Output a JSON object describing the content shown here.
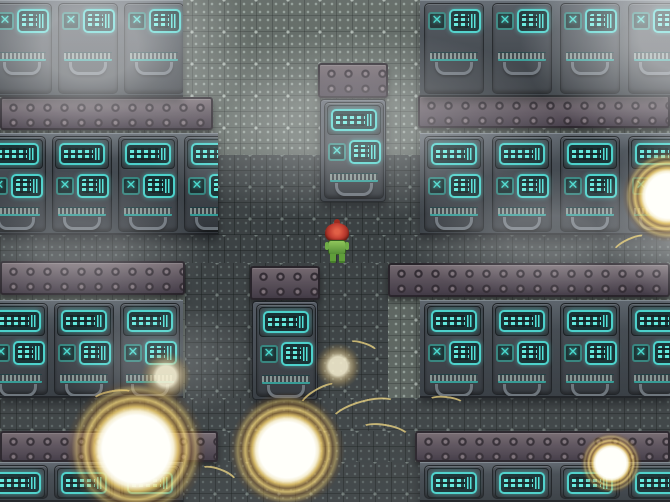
{
  "scene": {
    "width": 670,
    "height": 502,
    "type": "top-down-rpg",
    "setting": "sci-fi machine facility corridor"
  },
  "palette": {
    "wall": "#57605b",
    "wall_dot": "#c4d4cc",
    "floor": "#353b3d",
    "floor_dot": "#98aca6",
    "machine_light": "#565e66",
    "machine_dark": "#2e343a",
    "machine_edge": "#14181c",
    "screen_border": "#43cfc8",
    "screen_bg": "#0e282b",
    "screen_segment": "#60f0e4",
    "x_icon": "#3fd9cd",
    "beam": "#554c56",
    "beam_rivet": "#2b242c",
    "beam_edge": "#201b22",
    "explosion_core": "#fffdf4",
    "explosion_ring": "#f0c45e",
    "explosion_outer": "#a8762a",
    "player_hair": "#c23a2c",
    "player_body": "#7ab648",
    "fog": "#ffffff"
  },
  "icons": {
    "x_tile": "✕",
    "screen_bars": "equalizer-bars-icon",
    "rivet": "dot-rivet-icon",
    "vent": "slatted-vent-icon",
    "handle": "u-handle-icon"
  },
  "player": {
    "x": 325,
    "y": 219,
    "w": 24,
    "h": 45,
    "facing": "up"
  },
  "beams": [
    {
      "x": 0,
      "y": 97,
      "w": 213,
      "h": 33
    },
    {
      "x": 418,
      "y": 95,
      "w": 252,
      "h": 33
    },
    {
      "x": 0,
      "y": 261,
      "w": 185,
      "h": 34
    },
    {
      "x": 388,
      "y": 263,
      "w": 282,
      "h": 34
    },
    {
      "x": 0,
      "y": 431,
      "w": 218,
      "h": 31
    },
    {
      "x": 415,
      "y": 431,
      "w": 255,
      "h": 31
    }
  ],
  "floors": [
    {
      "x": 218,
      "y": 155,
      "w": 202,
      "h": 80
    },
    {
      "x": 0,
      "y": 235,
      "w": 670,
      "h": 28
    },
    {
      "x": 185,
      "y": 263,
      "w": 203,
      "h": 135
    },
    {
      "x": 0,
      "y": 398,
      "w": 670,
      "h": 33
    },
    {
      "x": 165,
      "y": 431,
      "w": 250,
      "h": 31
    },
    {
      "x": 183,
      "y": 462,
      "w": 237,
      "h": 40
    }
  ],
  "banks": [
    {
      "name": "top-left",
      "x": 0,
      "y": 0,
      "w": 183,
      "h": 97,
      "variant": "top",
      "units": [
        -8,
        58,
        124
      ]
    },
    {
      "name": "top-right",
      "x": 420,
      "y": 0,
      "w": 250,
      "h": 97,
      "variant": "top",
      "units": [
        4,
        72,
        140,
        208
      ]
    },
    {
      "name": "mid-left",
      "x": 0,
      "y": 133,
      "w": 218,
      "h": 102,
      "variant": "full",
      "units": [
        -14,
        52,
        118,
        184
      ]
    },
    {
      "name": "mid-right",
      "x": 420,
      "y": 133,
      "w": 250,
      "h": 102,
      "variant": "full",
      "units": [
        4,
        72,
        140,
        208
      ]
    },
    {
      "name": "lower-left",
      "x": 0,
      "y": 300,
      "w": 183,
      "h": 98,
      "variant": "full",
      "units": [
        -12,
        54,
        120
      ]
    },
    {
      "name": "lower-right",
      "x": 420,
      "y": 300,
      "w": 250,
      "h": 98,
      "variant": "full",
      "units": [
        4,
        72,
        140,
        208
      ]
    },
    {
      "name": "bottom-left",
      "x": 0,
      "y": 462,
      "w": 183,
      "h": 40,
      "variant": "cut",
      "units": [
        -12,
        54,
        120
      ]
    },
    {
      "name": "bottom-right",
      "x": 420,
      "y": 462,
      "w": 250,
      "h": 40,
      "variant": "cut",
      "units": [
        4,
        72,
        140,
        208
      ]
    }
  ],
  "pillars": [
    {
      "name": "door-top",
      "x": 318,
      "y": 63,
      "w": 70,
      "h": 139,
      "cap": 35
    },
    {
      "name": "door-bottom",
      "x": 250,
      "y": 266,
      "w": 70,
      "h": 134,
      "cap": 34
    }
  ],
  "explosions": [
    {
      "x": 136,
      "y": 449,
      "r": 70,
      "kind": "bright"
    },
    {
      "x": 287,
      "y": 450,
      "r": 58,
      "kind": "bright"
    },
    {
      "x": 338,
      "y": 366,
      "r": 23,
      "kind": "faint"
    },
    {
      "x": 166,
      "y": 376,
      "r": 25,
      "kind": "faint"
    },
    {
      "x": 668,
      "y": 196,
      "r": 46,
      "kind": "bright"
    },
    {
      "x": 611,
      "y": 463,
      "r": 31,
      "kind": "bright"
    }
  ],
  "sparks": [
    {
      "x": 330,
      "y": 400,
      "w": 70,
      "h": 26,
      "rot": -15
    },
    {
      "x": 360,
      "y": 424,
      "w": 50,
      "h": 18,
      "rot": 10
    },
    {
      "x": 298,
      "y": 388,
      "w": 42,
      "h": 14,
      "rot": -30
    },
    {
      "x": 428,
      "y": 396,
      "w": 36,
      "h": 12,
      "rot": 6
    },
    {
      "x": 92,
      "y": 390,
      "w": 42,
      "h": 14,
      "rot": -10
    },
    {
      "x": 198,
      "y": 468,
      "w": 40,
      "h": 16,
      "rot": 20
    },
    {
      "x": 612,
      "y": 238,
      "w": 36,
      "h": 12,
      "rot": -25
    },
    {
      "x": 348,
      "y": 342,
      "w": 30,
      "h": 10,
      "rot": 18
    }
  ],
  "fog": [
    {
      "x": -70,
      "y": -70,
      "w": 320,
      "h": 230,
      "op": 0.5
    },
    {
      "x": 520,
      "y": -90,
      "w": 340,
      "h": 250,
      "op": 0.55
    },
    {
      "x": 130,
      "y": 30,
      "w": 440,
      "h": 190,
      "op": 0.32
    },
    {
      "x": 596,
      "y": 120,
      "w": 220,
      "h": 190,
      "op": 0.5
    },
    {
      "x": -50,
      "y": 170,
      "w": 260,
      "h": 150,
      "op": 0.25
    },
    {
      "x": 400,
      "y": 170,
      "w": 300,
      "h": 130,
      "op": 0.28
    },
    {
      "x": 60,
      "y": 300,
      "w": 200,
      "h": 120,
      "op": 0.18
    }
  ]
}
